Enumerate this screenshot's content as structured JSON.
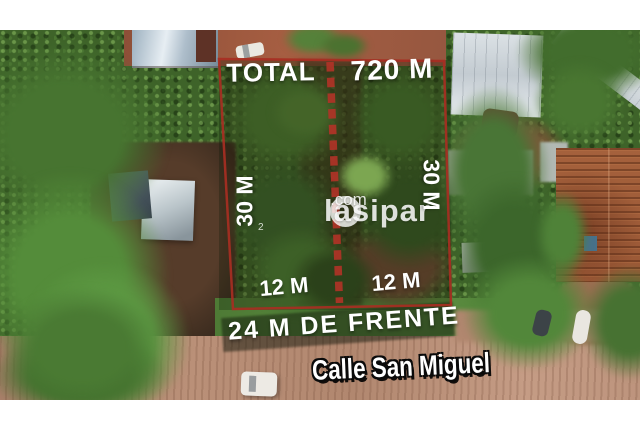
{
  "listing": {
    "total_label": "TOTAL",
    "total_area": "720 M",
    "left_side": "30 M",
    "right_side": "30 M",
    "left_half_front": "12 M",
    "right_half_front": "12 M",
    "front_total": "24 M DE FRENTE",
    "street_name": "Calle San Miguel"
  },
  "watermark": {
    "brand": "lasipar",
    "suffix": ".com",
    "mark": "2"
  },
  "colors": {
    "boundary_red": "#a82e22",
    "dash_red": "#b23327",
    "label_text": "#ffffff",
    "street_outline": "#000000",
    "frame_white": "#ffffff"
  }
}
